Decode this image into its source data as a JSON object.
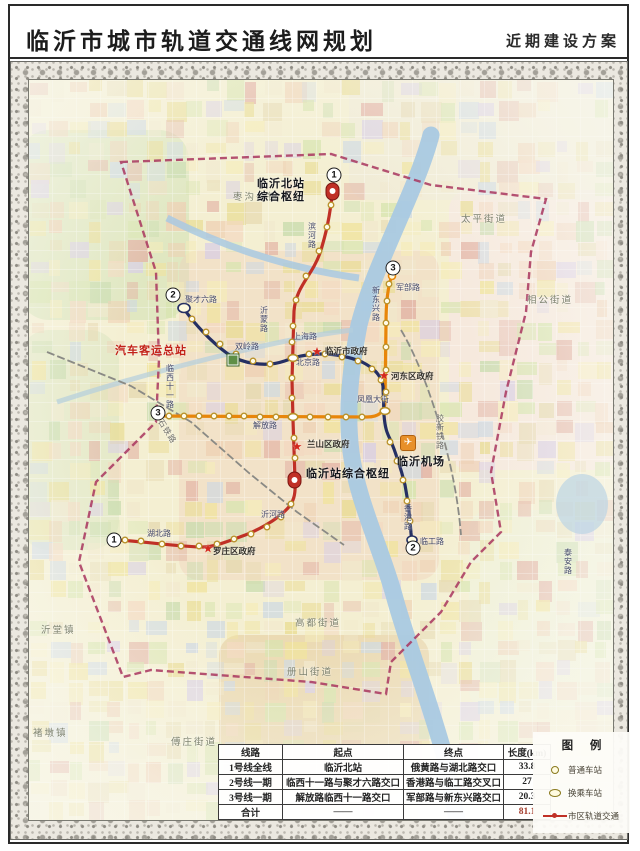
{
  "header": {
    "title": "临沂市城市轨道交通线网规划",
    "subtitle": "近期建设方案"
  },
  "legend": {
    "title": "图 例",
    "items": [
      {
        "symbol": "ordinary-station",
        "label": "普通车站"
      },
      {
        "symbol": "transfer-station",
        "label": "换乘车站"
      },
      {
        "symbol": "urban-rail-line",
        "label": "市区轨道交通"
      }
    ]
  },
  "table": {
    "headers": [
      "线路",
      "起点",
      "终点",
      "长度(km)"
    ],
    "rows": [
      [
        "1号线全线",
        "临沂北站",
        "俄黄路与湖北路交口",
        "33.8"
      ],
      [
        "2号线一期",
        "临西十一路与聚才六路交口",
        "香港路与临工路交叉口",
        "27"
      ],
      [
        "3号线一期",
        "解放路临西十一路交口",
        "军部路与新东兴路交口",
        "20.3"
      ],
      [
        "合计",
        "——",
        "——",
        "81.1"
      ]
    ]
  },
  "map": {
    "lines": [
      {
        "name": "1号线",
        "color": "#c03026",
        "endpoint_badge": "1"
      },
      {
        "name": "2号线",
        "color": "#252f63",
        "endpoint_badge": "2"
      },
      {
        "name": "3号线",
        "color": "#e8860a",
        "endpoint_badge": "3"
      }
    ],
    "boundary_color": "#a8355e",
    "river_color": "#a9c9e2",
    "badges": [
      {
        "text": "1",
        "x": 305,
        "y": 95
      },
      {
        "text": "1",
        "x": 85,
        "y": 460
      },
      {
        "text": "2",
        "x": 144,
        "y": 215
      },
      {
        "text": "2",
        "x": 384,
        "y": 468
      },
      {
        "text": "3",
        "x": 364,
        "y": 188
      },
      {
        "text": "3",
        "x": 129,
        "y": 333
      }
    ],
    "stars": [
      {
        "name": "临沂市政府",
        "x": 288,
        "y": 272
      },
      {
        "name": "河东区政府",
        "x": 355,
        "y": 296
      },
      {
        "name": "兰山区政府",
        "x": 268,
        "y": 367
      },
      {
        "name": "罗庄区政府",
        "x": 179,
        "y": 469
      }
    ],
    "labels": [
      {
        "text": "枣沟头镇",
        "x": 204,
        "y": 112,
        "cls": "district"
      },
      {
        "text": "太平街道",
        "x": 432,
        "y": 134,
        "cls": "district"
      },
      {
        "text": "相公街道",
        "x": 498,
        "y": 215,
        "cls": "district"
      },
      {
        "text": "沂堂镇",
        "x": 12,
        "y": 545,
        "cls": "district"
      },
      {
        "text": "高都街道",
        "x": 266,
        "y": 538,
        "cls": "district"
      },
      {
        "text": "册山街道",
        "x": 258,
        "y": 587,
        "cls": "district"
      },
      {
        "text": "傅庄街道",
        "x": 142,
        "y": 657,
        "cls": "district"
      },
      {
        "text": "褚墩镇",
        "x": 4,
        "y": 648,
        "cls": "district"
      },
      {
        "text": "临沂北站\n综合枢纽",
        "x": 228,
        "y": 98,
        "cls": "hub"
      },
      {
        "text": "汽车客运总站",
        "x": 86,
        "y": 265,
        "cls": "hub red"
      },
      {
        "text": "临沂站综合枢纽",
        "x": 277,
        "y": 388,
        "cls": "hub"
      },
      {
        "text": "临沂机场",
        "x": 368,
        "y": 376,
        "cls": "hub"
      },
      {
        "text": "临沂市政府",
        "x": 296,
        "y": 266,
        "cls": "gov"
      },
      {
        "text": "河东区政府",
        "x": 362,
        "y": 291,
        "cls": "gov"
      },
      {
        "text": "兰山区政府",
        "x": 278,
        "y": 359,
        "cls": "gov"
      },
      {
        "text": "罗庄区政府",
        "x": 184,
        "y": 466,
        "cls": "gov"
      },
      {
        "text": "上海路",
        "x": 264,
        "y": 252,
        "cls": "road"
      },
      {
        "text": "北京路",
        "x": 267,
        "y": 278,
        "cls": "road"
      },
      {
        "text": "解放路",
        "x": 224,
        "y": 341,
        "cls": "road"
      },
      {
        "text": "湖北路",
        "x": 118,
        "y": 449,
        "cls": "road"
      },
      {
        "text": "沂河路",
        "x": 232,
        "y": 430,
        "cls": "road"
      },
      {
        "text": "聚才六路",
        "x": 156,
        "y": 215,
        "cls": "road"
      },
      {
        "text": "双岭路",
        "x": 206,
        "y": 262,
        "cls": "road"
      },
      {
        "text": "凤凰大街",
        "x": 328,
        "y": 315,
        "cls": "road"
      },
      {
        "text": "军部路",
        "x": 367,
        "y": 203,
        "cls": "road"
      },
      {
        "text": "临工路",
        "x": 391,
        "y": 457,
        "cls": "road"
      },
      {
        "text": "临西十一路",
        "x": 136,
        "y": 284,
        "cls": "road vert"
      },
      {
        "text": "新东兴路",
        "x": 342,
        "y": 206,
        "cls": "road vert"
      },
      {
        "text": "香港路",
        "x": 374,
        "y": 424,
        "cls": "road vert"
      },
      {
        "text": "滨河路",
        "x": 278,
        "y": 142,
        "cls": "road vert"
      },
      {
        "text": "沂蒙路",
        "x": 230,
        "y": 226,
        "cls": "road vert"
      },
      {
        "text": "泰安路",
        "x": 534,
        "y": 468,
        "cls": "road vert"
      },
      {
        "text": "兖石铁路",
        "x": 130,
        "y": 330,
        "cls": "rail-label rot"
      },
      {
        "text": "胶新铁路",
        "x": 406,
        "y": 334,
        "cls": "rail-label vert"
      }
    ]
  }
}
